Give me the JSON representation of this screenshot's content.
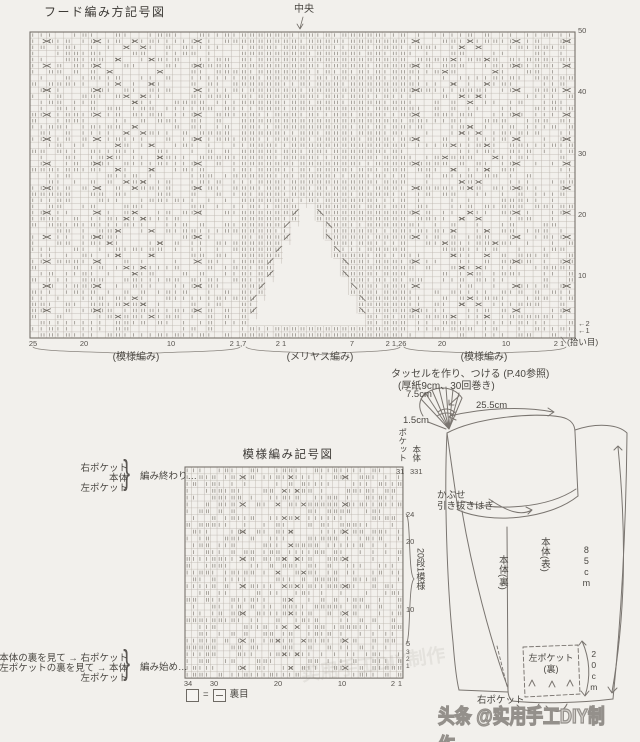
{
  "colors": {
    "paper": "#f2f0ec",
    "grid": "#bcb6ae",
    "border": "#76716b",
    "symbol": "#6e6962",
    "text": "#4a4742"
  },
  "hood_chart": {
    "title": "フード編み方記号図",
    "center_label": "中央",
    "pickup_label": "(拾い目)",
    "row_numbers": [
      {
        "t": "50",
        "y": 27
      },
      {
        "t": "40",
        "y": 88
      },
      {
        "t": "30",
        "y": 150
      },
      {
        "t": "20",
        "y": 211
      },
      {
        "t": "10",
        "y": 272
      },
      {
        "t": "←2",
        "y": 320
      },
      {
        "t": "←1",
        "y": 327
      }
    ],
    "col_numbers": [
      {
        "t": "25",
        "x": 33
      },
      {
        "t": "20",
        "x": 84
      },
      {
        "t": "10",
        "x": 171
      },
      {
        "t": "2 1,7",
        "x": 238
      },
      {
        "t": "2 1",
        "x": 281
      },
      {
        "t": "7",
        "x": 352
      },
      {
        "t": "2 1,26",
        "x": 396
      },
      {
        "t": "20",
        "x": 442
      },
      {
        "t": "10",
        "x": 506
      },
      {
        "t": "2 1",
        "x": 559
      }
    ],
    "sections": [
      {
        "label": "(模様編み)",
        "x1": 33,
        "x2": 240,
        "lx": 136
      },
      {
        "label": "(メリヤス編み)",
        "x1": 246,
        "x2": 400,
        "lx": 320
      },
      {
        "label": "(模様編み)",
        "x1": 404,
        "x2": 566,
        "lx": 484
      }
    ],
    "grid": {
      "cols": 65,
      "rows": 50,
      "x": 30,
      "y": 32,
      "cw": 8.3846,
      "ch": 6.12,
      "pickup_rows": 2,
      "cable_cols": [
        2,
        8,
        20,
        46,
        58,
        64
      ],
      "motif_cols": [
        13,
        53
      ],
      "motif_repeat": 14,
      "motif_style": "tall",
      "plain_cols": [
        26,
        45
      ],
      "notch": {
        "centerX": 308,
        "apexY": 205,
        "bottomY": 325.7,
        "maxHalfCols": 6.5
      }
    }
  },
  "pattern_chart": {
    "title": "模様編み記号図",
    "repeat_label": "20段1模様",
    "row_numbers": [
      {
        "t": "24",
        "y": 511
      },
      {
        "t": "20",
        "y": 538
      },
      {
        "t": "10",
        "y": 606
      },
      {
        "t": "5",
        "y": 640
      },
      {
        "t": "3",
        "y": 649,
        "s": 6.5
      },
      {
        "t": "2",
        "y": 656,
        "s": 6.5
      },
      {
        "t": "1",
        "y": 663,
        "s": 6.5
      }
    ],
    "col_numbers": [
      {
        "t": "34",
        "x": 188
      },
      {
        "t": "30",
        "x": 214
      },
      {
        "t": "20",
        "x": 278
      },
      {
        "t": "10",
        "x": 342
      },
      {
        "t": "2",
        "x": 393
      },
      {
        "t": "1",
        "x": 400
      }
    ],
    "top_labels": [
      {
        "name": "ポケット",
        "ny": 428,
        "num": "31",
        "x": 397
      },
      {
        "name": "本体",
        "ny": 445,
        "num": "331",
        "x": 411
      }
    ],
    "end_block": {
      "items": [
        "右ポケット",
        "本体",
        "左ポケット"
      ],
      "caption": "編み終わり…"
    },
    "start_block": {
      "items": [
        "本体の裏を見て → 右ポケット",
        "左ポケットの裏を見て → 本体",
        "左ポケット"
      ],
      "caption": "編み始め…"
    },
    "legend": {
      "eq": "=",
      "label": "裏目"
    },
    "grid": {
      "cols": 34,
      "rows": 31,
      "x": 185,
      "y": 467,
      "cw": 6.41,
      "ch": 6.81,
      "pickup_rows": 0,
      "cable_cols": [
        9,
        25
      ],
      "motif_cols": [
        17
      ],
      "motif_repeat": 10,
      "motif_style": "short"
    }
  },
  "notes": {
    "tassel_line1": "タッセルを作り、つける (P.40参照)",
    "tassel_line2": "(厚紙9cm、30回巻き)"
  },
  "schematic": {
    "labels": [
      {
        "t": "7.5cm",
        "x": 406,
        "y": 390
      },
      {
        "t": "1.5cm",
        "x": 403,
        "y": 416
      },
      {
        "t": "25.5cm",
        "x": 476,
        "y": 401
      },
      {
        "t": "かぶせ",
        "x": 437,
        "y": 491
      },
      {
        "t": "引き抜きはぎ",
        "x": 437,
        "y": 502
      },
      {
        "t": "本体(裏)",
        "x": 496,
        "y": 555,
        "vert": true
      },
      {
        "t": "本体(表)",
        "x": 538,
        "y": 537,
        "vert": true
      },
      {
        "t": "85cm",
        "x": 581,
        "y": 545,
        "vert": true,
        "upright": true,
        "s": 9
      },
      {
        "t": "左ポケット",
        "x": 551,
        "y": 653,
        "ctr": true,
        "s": 9
      },
      {
        "t": "(裏)",
        "x": 551,
        "y": 664,
        "ctr": true,
        "s": 9
      },
      {
        "t": "20cm",
        "x": 588,
        "y": 649,
        "vert": true,
        "upright": true,
        "s": 8.5
      },
      {
        "t": "右ポケット",
        "x": 477,
        "y": 696
      }
    ]
  },
  "watermark": {
    "text": "头条 @实用手工DIY制作",
    "ghost": "实用手工DIY制作"
  },
  "braces": {
    "curly": "}"
  }
}
